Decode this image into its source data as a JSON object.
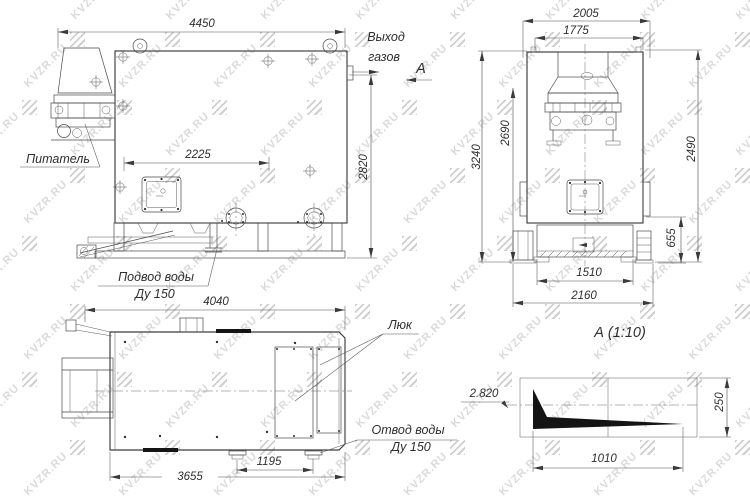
{
  "watermark": {
    "text": "KVZR.RU"
  },
  "side_view": {
    "labels": {
      "feeder": "Питатель",
      "water_inlet_1": "Подвод воды",
      "water_inlet_2": "Ду 150",
      "gas_outlet_1": "Выход",
      "gas_outlet_2": "газов",
      "section_mark": "А"
    },
    "dims": {
      "overall_length": "4450",
      "hatch_span": "2225",
      "height": "2820"
    }
  },
  "front_view": {
    "dims": {
      "top_width": "2005",
      "body_width": "1775",
      "overall_height": "3240",
      "left_height": "2690",
      "right_height": "2490",
      "base_height": "655",
      "base_span_inner": "1510",
      "base_span": "2160"
    }
  },
  "top_view": {
    "labels": {
      "hatch": "Люк",
      "water_outlet_1": "Отвод воды",
      "water_outlet_2": "Ду 150"
    },
    "dims": {
      "overall_length": "4040",
      "body_length": "3655",
      "nozzle_span": "1195"
    }
  },
  "detail_view": {
    "title": "А  (1:10)",
    "dims": {
      "level": "2.820",
      "height": "250",
      "length": "1010"
    }
  }
}
